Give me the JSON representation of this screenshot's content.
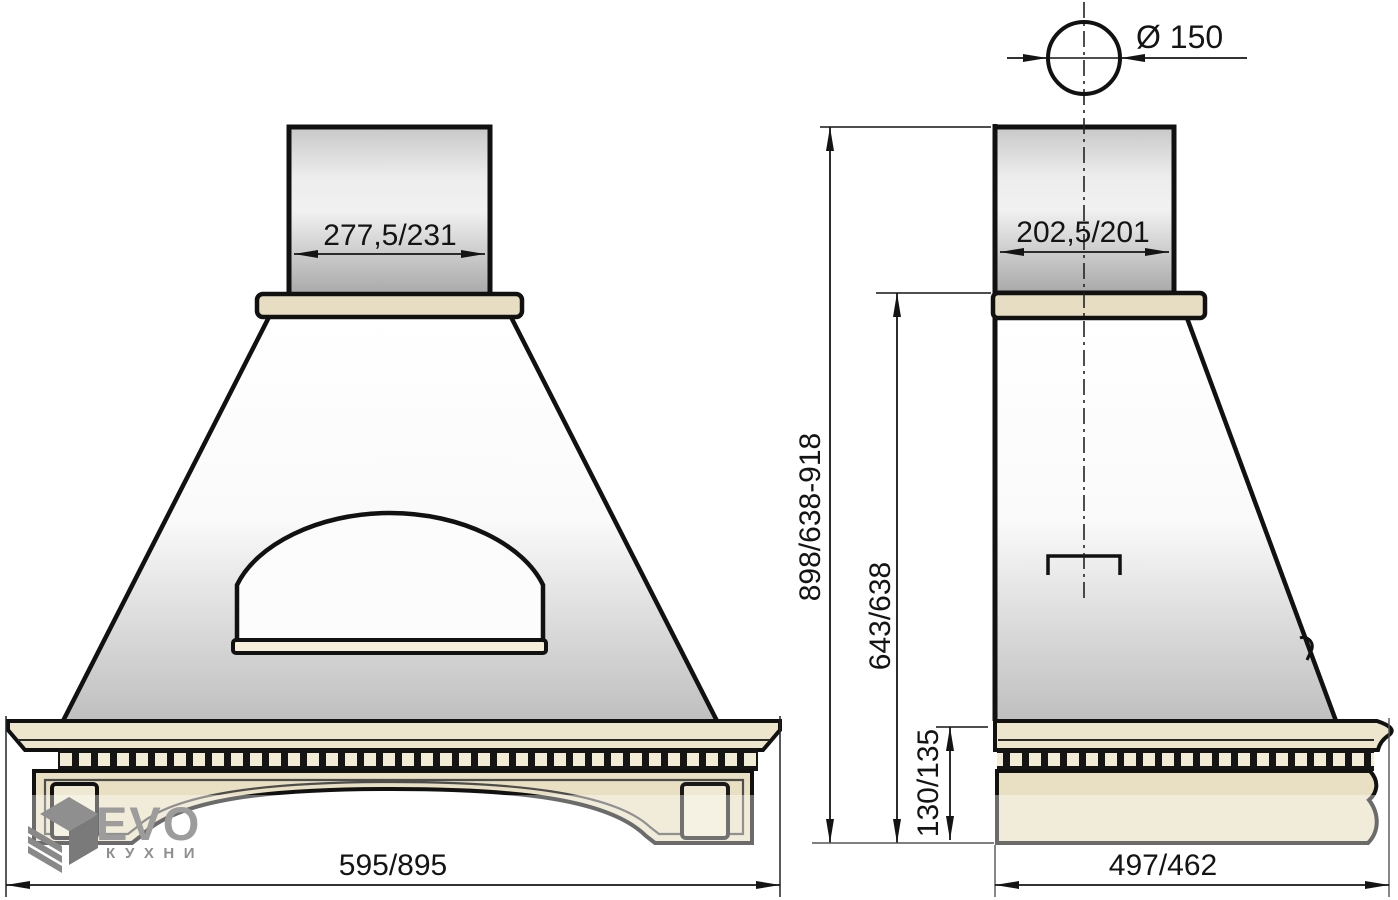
{
  "title": "Kitchen hood dimensional drawing",
  "dimensions": {
    "front_duct_width": "277,5/231",
    "front_base_width": "595/895",
    "side_duct_depth": "202,5/201",
    "side_base_depth": "497/462",
    "duct_diameter": "Ø 150",
    "total_height": "898/638-918",
    "body_height": "643/638",
    "cornice_height": "130/135"
  },
  "logo": {
    "brand": "EVO",
    "subtitle": "кухни",
    "icon": "evo-cube-icon"
  },
  "colors": {
    "outline": "#111111",
    "wood_beige": "#E7DDC2",
    "cornice_beige": "#EDE5CC",
    "frieze_beige": "#E9DFC3",
    "dentil_beige": "#F2ECD6",
    "sill_cream": "#F6F0DA",
    "block_beige": "#EFE8D2",
    "dimension_ink": "#141414",
    "logo_gray": "#9C9C9C"
  }
}
